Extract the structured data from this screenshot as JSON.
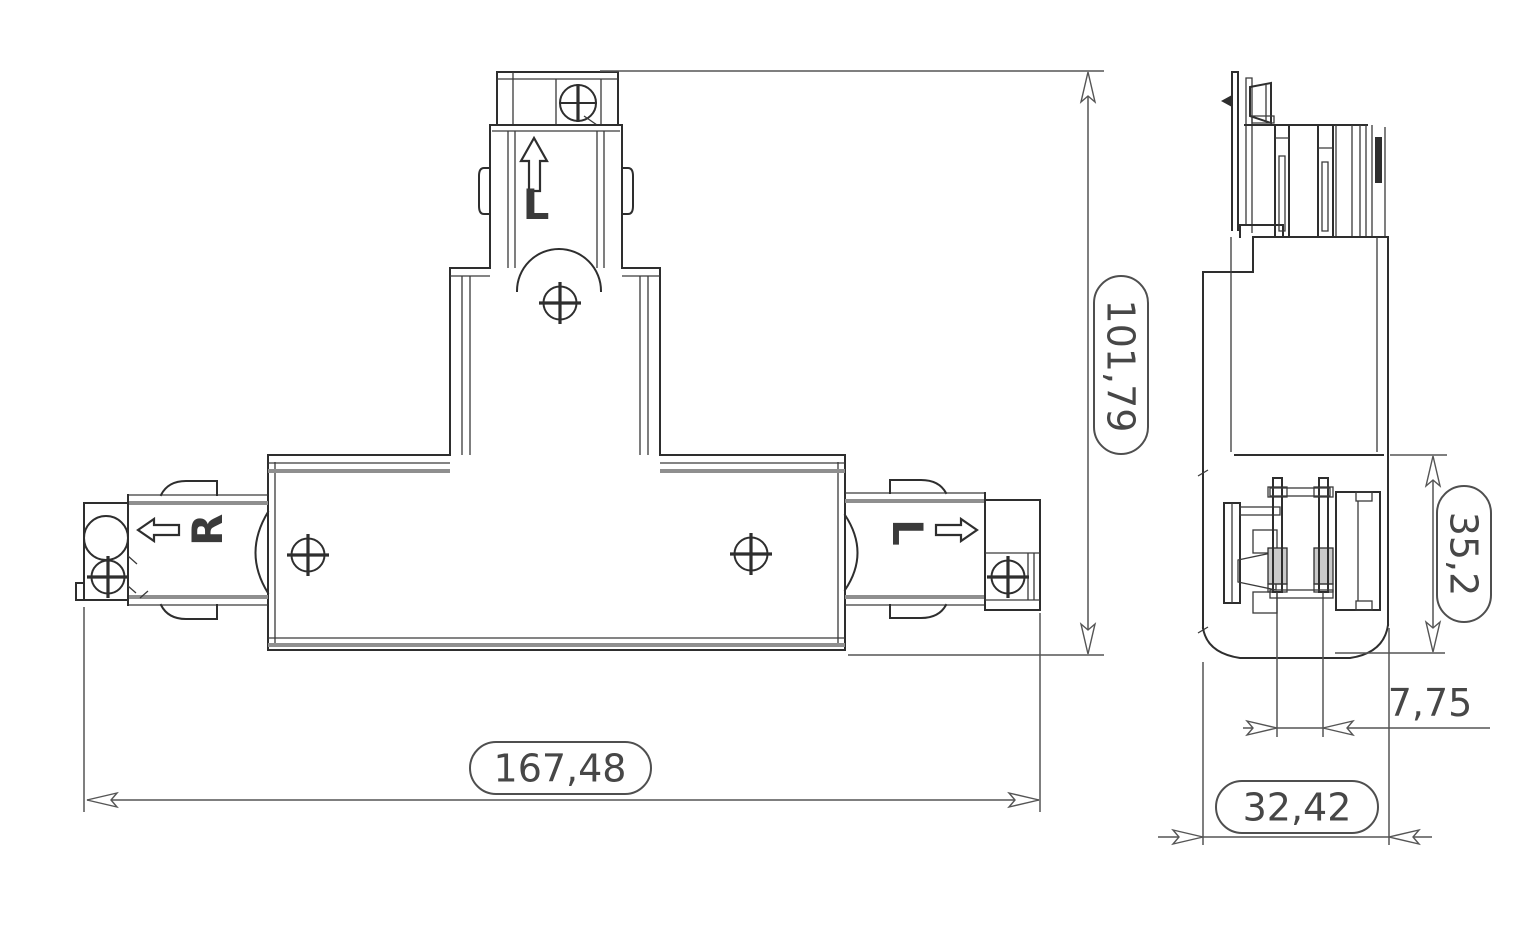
{
  "document": {
    "type": "technical-drawing",
    "subject": "track-lighting T-connector, front and side orthographic views"
  },
  "part_markings": {
    "top_branch_letter": "L",
    "left_branch_letter": "R",
    "right_branch_letter": "L"
  },
  "dimensions": {
    "overall_height": "101,79",
    "overall_width": "167,48",
    "side_height": "35,2",
    "contact_pitch": "7,75",
    "side_width": "32,42"
  },
  "icons": {
    "up_arrow": "direction-up-arrow",
    "left_arrow": "direction-left-arrow",
    "right_arrow": "direction-right-arrow",
    "screws": "phillips-screw-head"
  },
  "colors": {
    "background": "#ffffff",
    "line": "#2e2e2e",
    "groove": "#8f8f8f",
    "dimension": "#555555",
    "text": "#474747"
  }
}
